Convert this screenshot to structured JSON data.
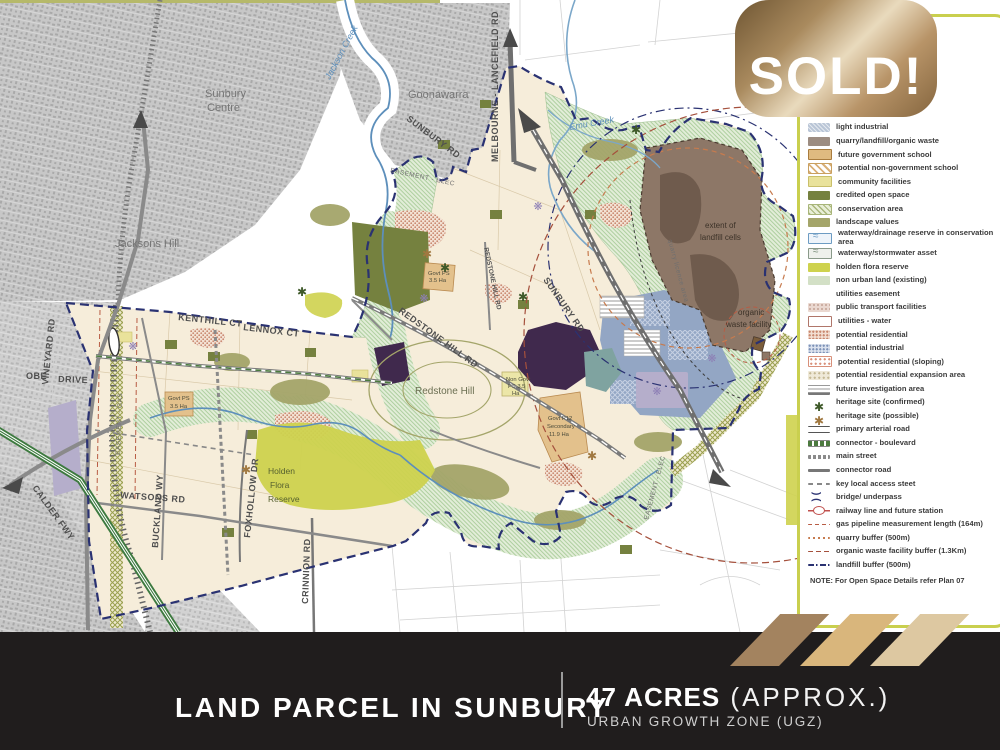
{
  "banner": {
    "sold_label": "SOLD!"
  },
  "footer": {
    "title": "LAND PARCEL IN SUNBURY",
    "acres": "47 ACRES",
    "acres_suffix": " (APPROX.)",
    "subtitle": "URBAN GROWTH ZONE (UGZ)"
  },
  "legend": {
    "items": [
      {
        "label": "light industrial",
        "swatch": "light-industrial",
        "color": "#b9c5d6"
      },
      {
        "label": "quarry/landfill/organic waste",
        "swatch": "quarry-waste",
        "color": "#9c8c81"
      },
      {
        "label": "future government school",
        "swatch": "future-gov-school",
        "color": "#dfba80"
      },
      {
        "label": "potential non-government school",
        "swatch": "non-gov-school",
        "color": "#d9b078"
      },
      {
        "label": "community facilities",
        "swatch": "community",
        "color": "#e9e29b"
      },
      {
        "label": "credited open space",
        "swatch": "credited-open",
        "color": "#75813f"
      },
      {
        "label": "conservation area",
        "swatch": "conservation",
        "color": "#a8b579"
      },
      {
        "label": "landscape values",
        "swatch": "landscape",
        "color": "#a4a56a"
      },
      {
        "label": "waterway/drainage reserve in conservation area",
        "swatch": "waterway-drainage",
        "color": "#6d9cc3"
      },
      {
        "label": "waterway/stormwater asset",
        "swatch": "waterway-stormwater",
        "color": "#8a9a8a"
      },
      {
        "label": "holden flora reserve",
        "swatch": "flora-reserve",
        "color": "#ced24e"
      },
      {
        "label": "non urban land (existing)",
        "swatch": "non-urban",
        "color": "#d3e0c6"
      },
      {
        "label": "utilities easement",
        "swatch": "utilities-easement",
        "color": "#9aa04f"
      },
      {
        "label": "public transport facilities",
        "swatch": "public-transport",
        "color": "#d9c0b5"
      },
      {
        "label": "utilities - water",
        "swatch": "utilities-water",
        "color": "#b0766a"
      },
      {
        "label": "potential residential",
        "swatch": "pot-residential",
        "color": "#c9886f"
      },
      {
        "label": "potential industrial",
        "swatch": "pot-industrial",
        "color": "#7e93b8"
      },
      {
        "label": "potential residential (sloping)",
        "swatch": "pot-res-sloping",
        "color": "#d8907a"
      },
      {
        "label": "potential residential expansion area",
        "swatch": "pot-res-expansion",
        "color": "#c4b894"
      },
      {
        "label": "future investigation area",
        "swatch": "future-investigation",
        "color": "#9a9a9a"
      },
      {
        "label": "heritage site (confirmed)",
        "swatch": "heritage-confirmed",
        "color": "#3f5a2a"
      },
      {
        "label": "heritage site (possible)",
        "swatch": "heritage-possible",
        "color": "#a07840"
      },
      {
        "label": "primary arterial road",
        "swatch": "arterial",
        "color": "#555555"
      },
      {
        "label": "connector - boulevard",
        "swatch": "boulevard",
        "color": "#4c7a3f"
      },
      {
        "label": "main street",
        "swatch": "main-street",
        "color": "#8a8a8a"
      },
      {
        "label": "connector road",
        "swatch": "connector",
        "color": "#777777"
      },
      {
        "label": "key local access steet",
        "swatch": "local-access",
        "color": "#888888"
      },
      {
        "label": "bridge/ underpass",
        "swatch": "bridge",
        "color": "#2a3272"
      },
      {
        "label": "railway line and future station",
        "swatch": "railway",
        "color": "#c0504d"
      },
      {
        "label": "gas pipeline measurement length (164m)",
        "swatch": "gas-pipeline",
        "color": "#b85c44"
      },
      {
        "label": "quarry buffer (500m)",
        "swatch": "quarry-buffer",
        "color": "#c77b4e"
      },
      {
        "label": "organic waste facility buffer (1.3Km)",
        "swatch": "organic-buffer",
        "color": "#a5503c"
      },
      {
        "label": "landfill buffer (500m)",
        "swatch": "landfill-buffer",
        "color": "#2a3272"
      }
    ],
    "note": "NOTE: For Open Space Details refer Plan 07"
  },
  "map": {
    "labels": {
      "sunbury_centre_1": "Sunbury",
      "sunbury_centre_2": "Centre",
      "goonawarra": "Goonawarra",
      "jacksons_hill": "Jacksons Hill",
      "jackson_creek": "Jackson Creek",
      "emu_creek": "Emu Creek",
      "sunbury_rd": "SUNBURY RD",
      "melbourne_lancefield_rd": "MELBOURNE - LANCEFIELD RD",
      "easement_elec": "EASEMENT - ELEC",
      "easement_gas": "EASEMENT - GAS",
      "redstone_hill_rd": "REDSTONE HILL RD",
      "redstone_hill": "Redstone Hill",
      "govt_ps_1": "Govt PS",
      "govt_ps_2": "3.5 Ha",
      "non_govt_ps_1": "Non Govt",
      "non_govt_ps_2": "PS 3.5",
      "non_govt_ps_3": "Ha",
      "govt_p12_1": "Govt P12",
      "govt_p12_2": "Secondary",
      "govt_p12_3": "11.9 Ha",
      "extent_landfill_1": "extent of",
      "extent_landfill_2": "landfill cells",
      "organic_waste_1": "organic",
      "organic_waste_2": "waste facility",
      "quarry_licence": "quarry licence area",
      "vineyard_rd": "VINEYARD RD",
      "kenthill_ct": "KENTHILL CT",
      "lennox_ct": "LENNOX CT",
      "oberon_1": "OBE",
      "oberon_2": "DRIVE",
      "buckland_wy": "BUCKLAND WY",
      "watsons_rd": "WATSONS RD",
      "foxhollow_dr": "FOXHOLLOW DR",
      "crinnion_rd": "CRINNION RD",
      "calder_fwy": "CALDER FWY",
      "holden_flora_1": "Holden",
      "holden_flora_2": "Flora",
      "holden_flora_3": "Reserve"
    }
  },
  "colors": {
    "gold_banner": "#b7986a",
    "footer_bar": "#201d1d",
    "ugz_boundary": "#2a3272",
    "plan_cream": "#f6edda",
    "sold_parcel_purple": "#40294d",
    "legend_border": "#c9cf4e",
    "calder_green": "#3d7a3f",
    "quarry_buffer_orange": "#c77b4e",
    "organic_buffer_red": "#a5503c",
    "stripe_1": "#a3835f",
    "stripe_2": "#d9b67c",
    "stripe_3": "#ddc8a1"
  }
}
